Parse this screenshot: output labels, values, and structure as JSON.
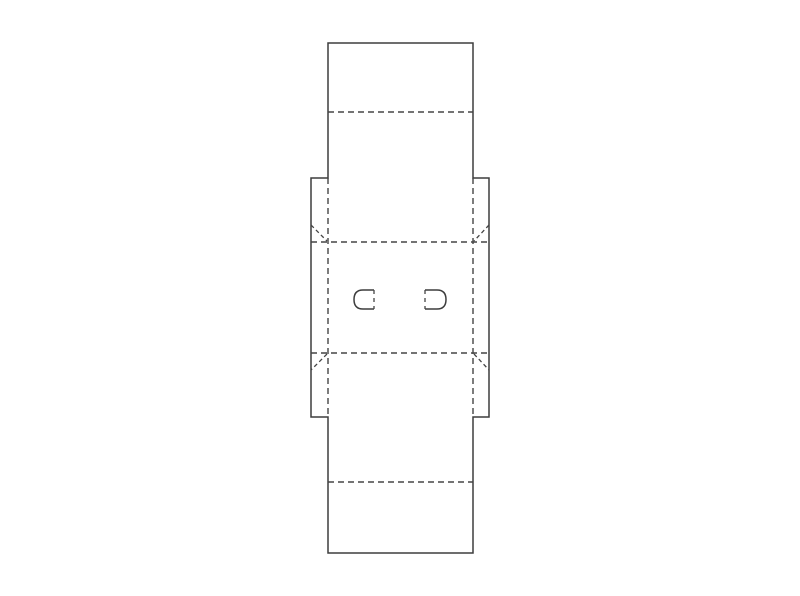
{
  "canvas": {
    "width": 800,
    "height": 596,
    "background": "#ffffff"
  },
  "dieline": {
    "description": "box-packaging-dieline-template",
    "cut_stroke": {
      "color": "#3d3d3d",
      "width": 1.5
    },
    "fold_stroke": {
      "color": "#454545",
      "width": 1.4,
      "dash": "6 4"
    },
    "diagonal_stroke": {
      "color": "#454545",
      "width": 1.3,
      "dash": "4 3"
    },
    "slot_fold_stroke": {
      "color": "#454545",
      "width": 1.3,
      "dash": "4 4"
    },
    "cut_outline_points": [
      [
        328,
        43
      ],
      [
        473,
        43
      ],
      [
        473,
        178
      ],
      [
        489,
        178
      ],
      [
        489,
        417
      ],
      [
        473,
        417
      ],
      [
        473,
        553
      ],
      [
        328,
        553
      ],
      [
        328,
        417
      ],
      [
        311,
        417
      ],
      [
        311,
        178
      ],
      [
        328,
        178
      ]
    ],
    "fold_lines": [
      {
        "id": "top-flap-crease",
        "x1": 328,
        "y1": 112,
        "x2": 473,
        "y2": 112
      },
      {
        "id": "upper-panel-crease",
        "x1": 311,
        "y1": 242,
        "x2": 489,
        "y2": 242
      },
      {
        "id": "lower-panel-crease",
        "x1": 311,
        "y1": 353,
        "x2": 489,
        "y2": 353
      },
      {
        "id": "bottom-flap-crease",
        "x1": 328,
        "y1": 482,
        "x2": 473,
        "y2": 482
      },
      {
        "id": "left-vertical-crease",
        "x1": 328,
        "y1": 178,
        "x2": 328,
        "y2": 417
      },
      {
        "id": "right-vertical-crease",
        "x1": 473,
        "y1": 178,
        "x2": 473,
        "y2": 417
      }
    ],
    "diagonal_folds": [
      {
        "id": "gusset-top-left",
        "x1": 311,
        "y1": 225,
        "x2": 327,
        "y2": 241
      },
      {
        "id": "gusset-top-right",
        "x1": 489,
        "y1": 225,
        "x2": 474,
        "y2": 241
      },
      {
        "id": "gusset-bottom-left",
        "x1": 327,
        "y1": 354,
        "x2": 311,
        "y2": 370
      },
      {
        "id": "gusset-bottom-right",
        "x1": 474,
        "y1": 354,
        "x2": 489,
        "y2": 370
      }
    ],
    "slots": [
      {
        "id": "left-slot",
        "cut_path": "M 374 290 L 363 290 Q 354 290 354 299.5 Q 354 309 363 309 L 374 309",
        "fold_edge": {
          "x1": 374,
          "y1": 290,
          "x2": 374,
          "y2": 309
        }
      },
      {
        "id": "right-slot",
        "cut_path": "M 425 290 L 437 290 Q 446 290 446 299.5 Q 446 309 437 309 L 425 309",
        "fold_edge": {
          "x1": 425,
          "y1": 290,
          "x2": 425,
          "y2": 309
        }
      }
    ]
  }
}
